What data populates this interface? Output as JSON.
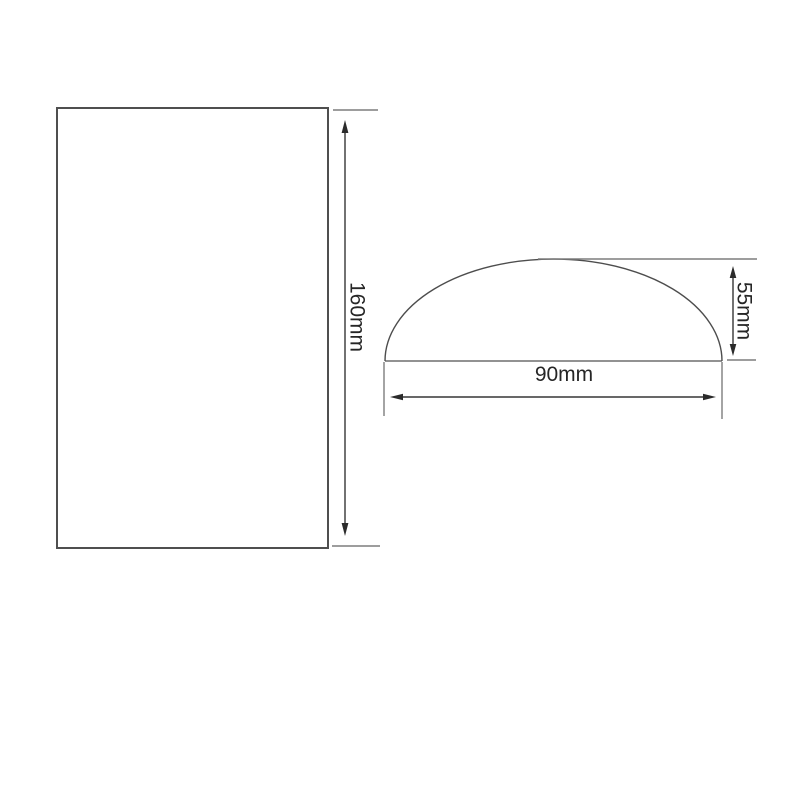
{
  "figure": {
    "type": "technical-dimension-drawing",
    "views": {
      "front_panel": {
        "shape": "rectangle",
        "height": {
          "label": "160mm"
        }
      },
      "dome_profile": {
        "shape": "semi-elliptical dome segment",
        "height": {
          "label": "55mm"
        },
        "width": {
          "label": "90mm"
        }
      }
    },
    "colors": {
      "background": "#ffffff",
      "outline": "#4f4f4f",
      "extension_line": "#7d7d7d",
      "dimension_line": "#363636",
      "text": "#262626"
    }
  }
}
